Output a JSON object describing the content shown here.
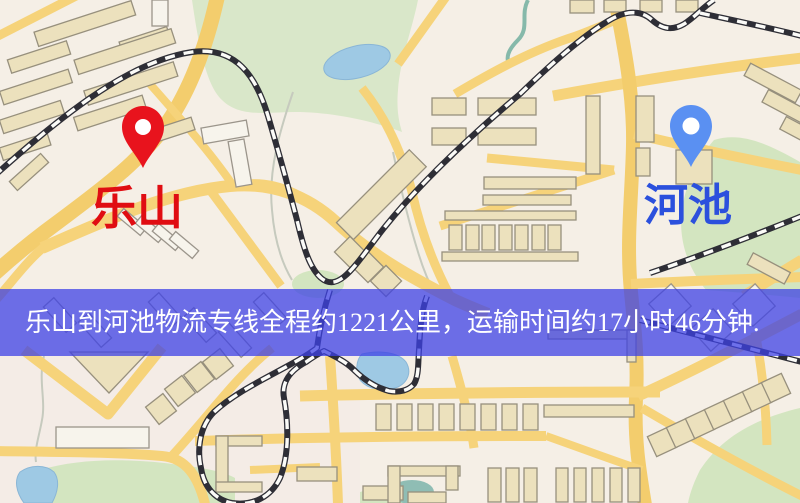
{
  "banner": {
    "text": "乐山到河池物流专线全程约1221公里，运输时间约17小时46分钟.",
    "background_color": "#3e42e6",
    "opacity": "0.75",
    "text_color": "#ffffff"
  },
  "route": {
    "origin": "乐山",
    "destination": "河池",
    "distance": "约1221公里",
    "duration": "约17小时46分钟"
  },
  "markers": {
    "origin": {
      "label": "乐山",
      "pin_color": "#e8131d",
      "label_color": "#e00d12"
    },
    "destination": {
      "label": "河池",
      "pin_color": "#5a90f2",
      "label_color": "#2b50dd"
    }
  },
  "map_colors": {
    "background": "#f5efe6",
    "road_yellow": "#f6d37a",
    "building_fill": "#ece1bd",
    "building_outline": "#97907d",
    "park_green": "#d9e7c9",
    "water_blue": "#9ec9e4",
    "railway_dark": "#2e2e36"
  }
}
